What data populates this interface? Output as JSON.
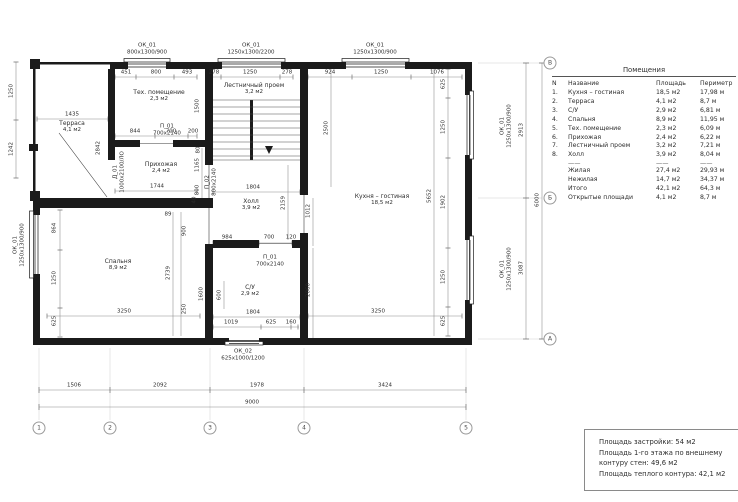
{
  "plan": {
    "rooms": [
      {
        "name": "Терраса",
        "area": "4,1 м2",
        "x": 72,
        "y": 127
      },
      {
        "name": "Тех. помещение",
        "area": "2,3 м2",
        "x": 159,
        "y": 96
      },
      {
        "name": "Лестничный проем",
        "area": "3,2 м2",
        "x": 254,
        "y": 89
      },
      {
        "name": "Прихожая",
        "area": "2,4 м2",
        "x": 161,
        "y": 168
      },
      {
        "name": "Холл",
        "area": "3,9 м2",
        "x": 251,
        "y": 205
      },
      {
        "name": "Спальня",
        "area": "8,9 м2",
        "x": 118,
        "y": 265
      },
      {
        "name": "С/У",
        "area": "2,9 м2",
        "x": 250,
        "y": 291
      },
      {
        "name": "Кухня – гостиная",
        "area": "18,5 м2",
        "x": 382,
        "y": 200
      }
    ],
    "openings": [
      {
        "code": "ОК_01",
        "size": "800х1300/900",
        "x": 147,
        "y": 49
      },
      {
        "code": "ОК_01",
        "size": "1250х1300/2200",
        "x": 251,
        "y": 49
      },
      {
        "code": "ОК_01",
        "size": "1250х1300/900",
        "x": 375,
        "y": 49
      },
      {
        "code": "ОК_01",
        "size": "1250х1300/900",
        "x": 506,
        "y": 126,
        "r": 1
      },
      {
        "code": "ОК_01",
        "size": "1250х1300/900",
        "x": 506,
        "y": 269,
        "r": 1
      },
      {
        "code": "ОК_01",
        "size": "1250х1300/900",
        "x": 19,
        "y": 245,
        "r": 1
      },
      {
        "code": "ОК_02",
        "size": "625х1000/1200",
        "x": 243,
        "y": 355
      },
      {
        "code": "П_01",
        "size": "700х2140",
        "x": 167,
        "y": 130
      },
      {
        "code": "П_01",
        "size": "700х2140",
        "x": 270,
        "y": 261
      },
      {
        "code": "П_02",
        "size": "800х2140",
        "x": 211,
        "y": 182,
        "r": 1
      },
      {
        "code": "Д_01",
        "size": "1000х2100/ЛО",
        "x": 119,
        "y": 172,
        "r": 1
      }
    ],
    "dims": [
      {
        "t": "451",
        "x": 126,
        "y": 73
      },
      {
        "t": "800",
        "x": 156,
        "y": 73
      },
      {
        "t": "493",
        "x": 187,
        "y": 73
      },
      {
        "t": "278",
        "x": 214,
        "y": 73
      },
      {
        "t": "1250",
        "x": 250,
        "y": 73
      },
      {
        "t": "278",
        "x": 287,
        "y": 73
      },
      {
        "t": "924",
        "x": 330,
        "y": 73
      },
      {
        "t": "1250",
        "x": 381,
        "y": 73
      },
      {
        "t": "1076",
        "x": 437,
        "y": 73
      },
      {
        "t": "1435",
        "x": 72,
        "y": 115
      },
      {
        "t": "1250",
        "x": 12,
        "y": 91,
        "r": 1
      },
      {
        "t": "1242",
        "x": 12,
        "y": 149,
        "r": 1
      },
      {
        "t": "2842",
        "x": 99,
        "y": 148,
        "r": 1
      },
      {
        "t": "1500",
        "x": 198,
        "y": 106,
        "r": 1
      },
      {
        "t": "844",
        "x": 135,
        "y": 132
      },
      {
        "t": "700",
        "x": 171,
        "y": 132
      },
      {
        "t": "200",
        "x": 193,
        "y": 132
      },
      {
        "t": "80",
        "x": 199,
        "y": 150,
        "r": 1
      },
      {
        "t": "1165",
        "x": 198,
        "y": 165,
        "r": 1
      },
      {
        "t": "800",
        "x": 198,
        "y": 190,
        "r": 1
      },
      {
        "t": "1744",
        "x": 157,
        "y": 187
      },
      {
        "t": "40",
        "x": 195,
        "y": 200,
        "r": 1
      },
      {
        "t": "2500",
        "x": 327,
        "y": 128,
        "r": 1
      },
      {
        "t": "1804",
        "x": 253,
        "y": 188
      },
      {
        "t": "2159",
        "x": 284,
        "y": 203,
        "r": 1
      },
      {
        "t": "984",
        "x": 227,
        "y": 238
      },
      {
        "t": "700",
        "x": 269,
        "y": 238
      },
      {
        "t": "120",
        "x": 291,
        "y": 238
      },
      {
        "t": "1600",
        "x": 202,
        "y": 294,
        "r": 1
      },
      {
        "t": "600",
        "x": 220,
        "y": 295,
        "r": 1
      },
      {
        "t": "1804",
        "x": 253,
        "y": 313
      },
      {
        "t": "1019",
        "x": 231,
        "y": 323
      },
      {
        "t": "625",
        "x": 271,
        "y": 323
      },
      {
        "t": "160",
        "x": 291,
        "y": 323
      },
      {
        "t": "864",
        "x": 55,
        "y": 228,
        "r": 1
      },
      {
        "t": "1250",
        "x": 55,
        "y": 278,
        "r": 1
      },
      {
        "t": "625",
        "x": 55,
        "y": 321,
        "r": 1
      },
      {
        "t": "3250",
        "x": 124,
        "y": 312
      },
      {
        "t": "89",
        "x": 168,
        "y": 215
      },
      {
        "t": "900",
        "x": 185,
        "y": 231,
        "r": 1
      },
      {
        "t": "2739",
        "x": 169,
        "y": 273,
        "r": 1
      },
      {
        "t": "250",
        "x": 185,
        "y": 309,
        "r": 1
      },
      {
        "t": "1012",
        "x": 309,
        "y": 211,
        "r": 1
      },
      {
        "t": "2060",
        "x": 309,
        "y": 290,
        "r": 1
      },
      {
        "t": "5652",
        "x": 430,
        "y": 196,
        "r": 1
      },
      {
        "t": "625",
        "x": 444,
        "y": 84,
        "r": 1
      },
      {
        "t": "1250",
        "x": 444,
        "y": 127,
        "r": 1
      },
      {
        "t": "1902",
        "x": 444,
        "y": 202,
        "r": 1
      },
      {
        "t": "1250",
        "x": 444,
        "y": 277,
        "r": 1
      },
      {
        "t": "625",
        "x": 444,
        "y": 321,
        "r": 1
      },
      {
        "t": "3250",
        "x": 378,
        "y": 312
      },
      {
        "t": "2913",
        "x": 522,
        "y": 130,
        "r": 1
      },
      {
        "t": "3087",
        "x": 522,
        "y": 268,
        "r": 1
      },
      {
        "t": "6000",
        "x": 538,
        "y": 200,
        "r": 1
      },
      {
        "t": "1506",
        "x": 74,
        "y": 386
      },
      {
        "t": "2092",
        "x": 160,
        "y": 386
      },
      {
        "t": "1978",
        "x": 257,
        "y": 386
      },
      {
        "t": "3424",
        "x": 385,
        "y": 386
      },
      {
        "t": "9000",
        "x": 252,
        "y": 403
      }
    ],
    "axes_bottom": [
      {
        "label": "1",
        "x": 39
      },
      {
        "label": "2",
        "x": 110
      },
      {
        "label": "3",
        "x": 210
      },
      {
        "label": "4",
        "x": 304
      },
      {
        "label": "5",
        "x": 466
      }
    ],
    "axes_right": [
      {
        "label": "В",
        "y": 63
      },
      {
        "label": "Б",
        "y": 198
      },
      {
        "label": "А",
        "y": 339
      }
    ]
  },
  "rooms_table": {
    "title": "Помещения",
    "headers": {
      "num": "N",
      "name": "Название",
      "area": "Площадь",
      "perimeter": "Периметр"
    },
    "rows": [
      {
        "num": "1.",
        "name": "Кухня – гостиная",
        "area": "18,5 м2",
        "perimeter": "17,98 м"
      },
      {
        "num": "2.",
        "name": "Терраса",
        "area": "4,1 м2",
        "perimeter": "8,7 м"
      },
      {
        "num": "3.",
        "name": "С/У",
        "area": "2,9 м2",
        "perimeter": "6,81 м"
      },
      {
        "num": "4.",
        "name": "Спальня",
        "area": "8,9 м2",
        "perimeter": "11,95 м"
      },
      {
        "num": "5.",
        "name": "Тех. помещение",
        "area": "2,3 м2",
        "perimeter": "6,09 м"
      },
      {
        "num": "6.",
        "name": "Прихожая",
        "area": "2,4 м2",
        "perimeter": "6,22 м"
      },
      {
        "num": "7.",
        "name": "Лестничный проем",
        "area": "3,2 м2",
        "perimeter": "7,21 м"
      },
      {
        "num": "8.",
        "name": "Холл",
        "area": "3,9 м2",
        "perimeter": "8,04 м"
      }
    ],
    "separator": "——",
    "totals": [
      {
        "num": "",
        "name": "Жилая",
        "area": "27,4 м2",
        "perimeter": "29,93 м"
      },
      {
        "num": "",
        "name": "Нежилая",
        "area": "14,7 м2",
        "perimeter": "34,37 м"
      },
      {
        "num": "",
        "name": "Итого",
        "area": "42,1 м2",
        "perimeter": "64,3 м"
      },
      {
        "num": "",
        "name": "Открытые площади",
        "area": "4,1 м2",
        "perimeter": "8,7 м"
      }
    ]
  },
  "notes": {
    "lines": [
      "Площадь застройки: 54 м2",
      "Площадь 1-го этажа по внешнему контуру стен: 49,6 м2",
      "Площадь теплого контура: 42,1 м2"
    ]
  }
}
